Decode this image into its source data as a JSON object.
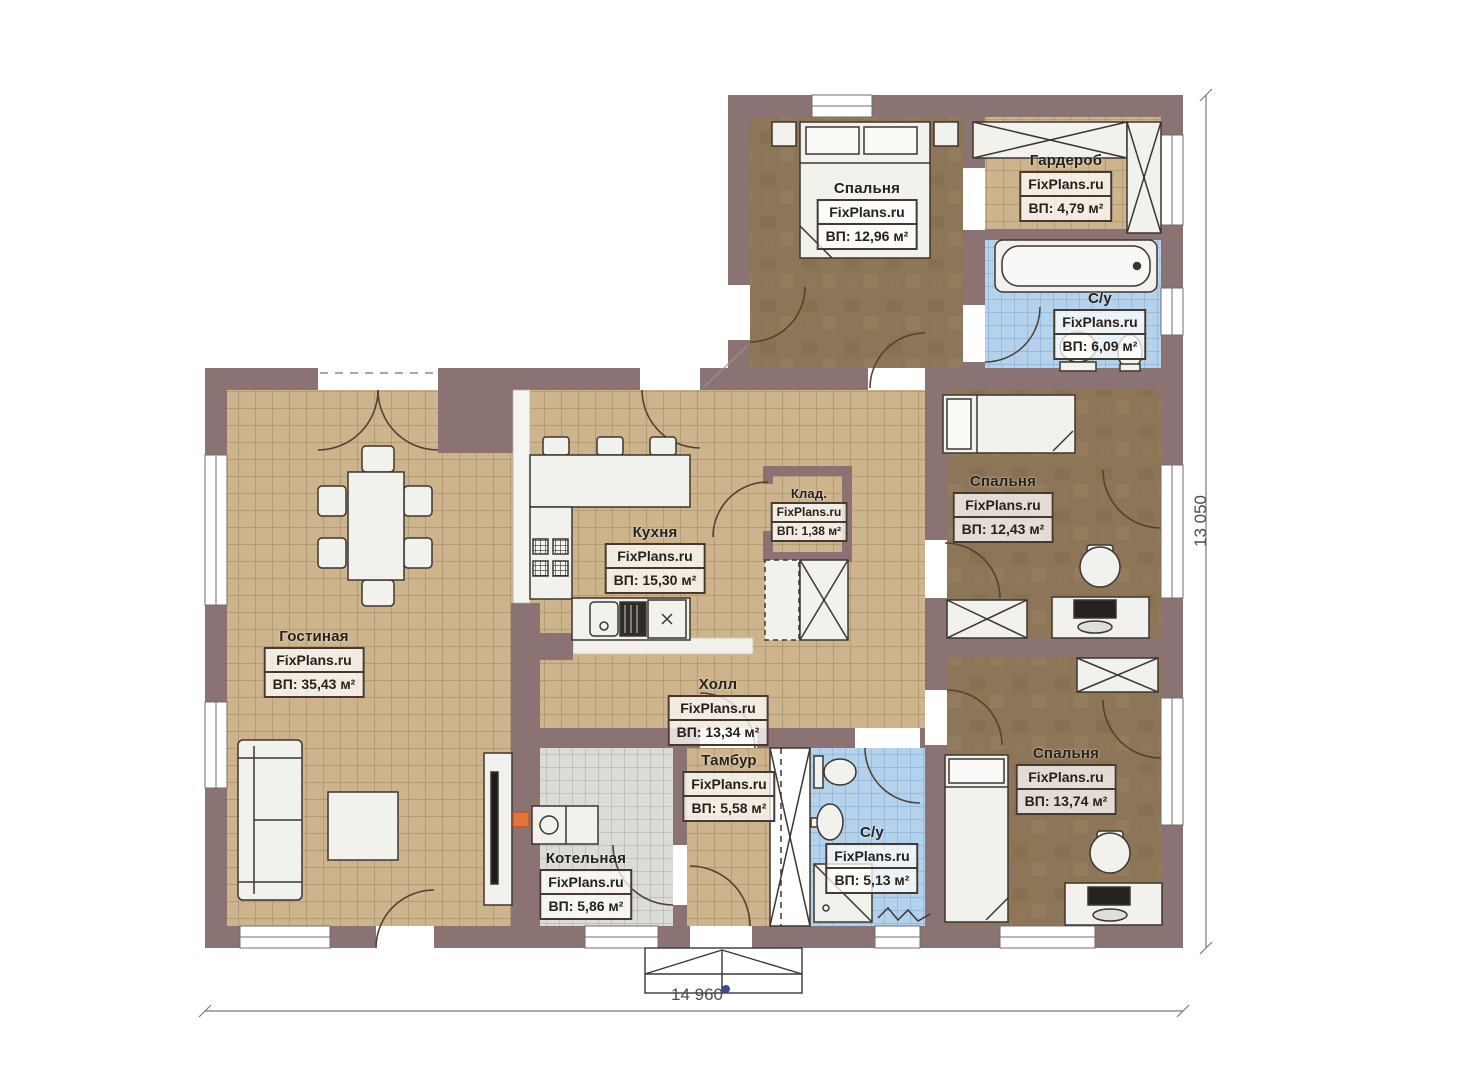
{
  "plan": {
    "brand": "FixPlans.ru",
    "rooms": [
      {
        "id": "bedroom-1",
        "name": "Спальня",
        "brand": "FixPlans.ru",
        "area": "ВП: 12,96 м²"
      },
      {
        "id": "wardrobe",
        "name": "Гардероб",
        "brand": "FixPlans.ru",
        "area": "ВП: 4,79 м²"
      },
      {
        "id": "bathroom-1",
        "name": "С/у",
        "brand": "FixPlans.ru",
        "area": "ВП: 6,09 м²"
      },
      {
        "id": "living",
        "name": "Гостиная",
        "brand": "FixPlans.ru",
        "area": "ВП: 35,43 м²"
      },
      {
        "id": "kitchen",
        "name": "Кухня",
        "brand": "FixPlans.ru",
        "area": "ВП: 15,30 м²"
      },
      {
        "id": "storage",
        "name": "Клад.",
        "brand": "FixPlans.ru",
        "area": "ВП: 1,38 м²"
      },
      {
        "id": "hall",
        "name": "Холл",
        "brand": "FixPlans.ru",
        "area": "ВП: 13,34 м²"
      },
      {
        "id": "vestibule",
        "name": "Тамбур",
        "brand": "FixPlans.ru",
        "area": "ВП: 5,58 м²"
      },
      {
        "id": "boiler",
        "name": "Котельная",
        "brand": "FixPlans.ru",
        "area": "ВП: 5,86 м²"
      },
      {
        "id": "bathroom-2",
        "name": "С/у",
        "brand": "FixPlans.ru",
        "area": "ВП: 5,13 м²"
      },
      {
        "id": "bedroom-2",
        "name": "Спальня",
        "brand": "FixPlans.ru",
        "area": "ВП: 12,43 м²"
      },
      {
        "id": "bedroom-3",
        "name": "Спальня",
        "brand": "FixPlans.ru",
        "area": "ВП: 13,74 м²"
      }
    ],
    "dimensions": {
      "width": "14 960",
      "height": "13 050"
    },
    "colors": {
      "wall": "#8a7372",
      "floor_tile_tan": "#cdb48c",
      "bathroom_tile_blue": "#b5d2ec",
      "boiler_tile_gray": "#dbdbd8",
      "bedroom_floor_brown": "#8d7557",
      "accent_orange": "#e0763c"
    }
  }
}
